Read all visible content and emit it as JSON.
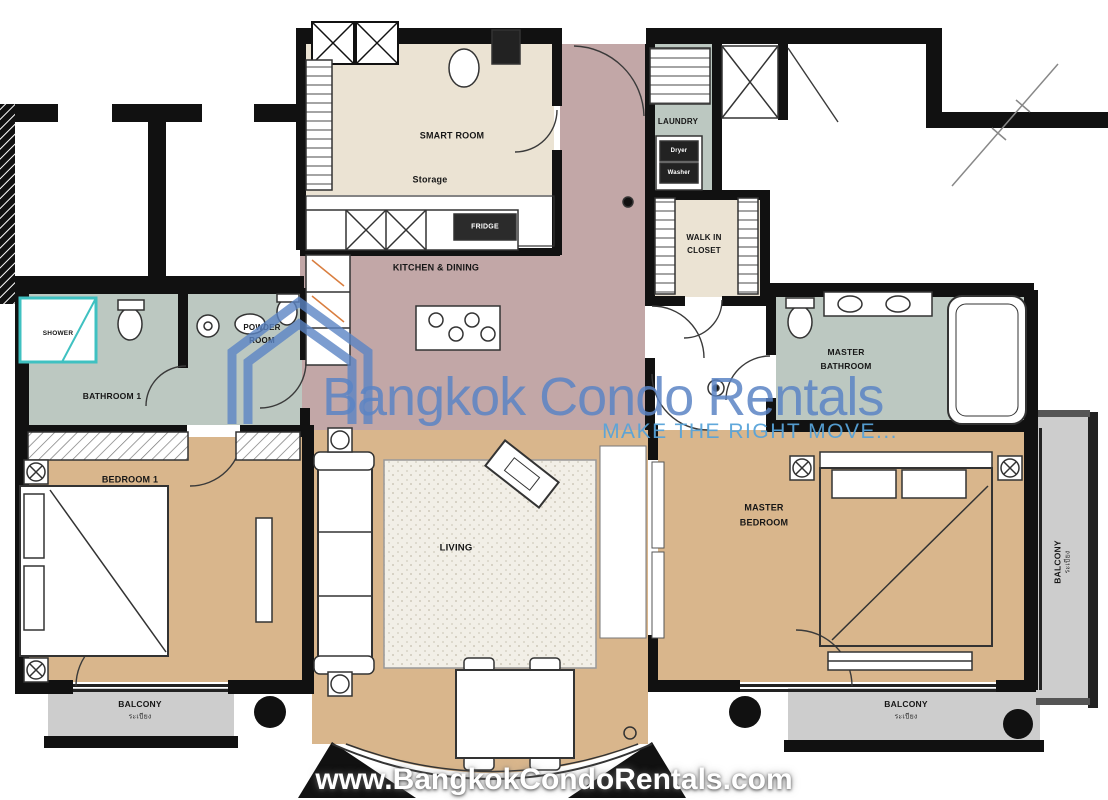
{
  "watermark": {
    "brand": "Bangkok Condo Rentals",
    "tagline": "MAKE THE RIGHT MOVE...",
    "website": "www.BangkokCondoRentals.com",
    "brand_color": "#5b84c4",
    "tagline_color": "#57a3d9"
  },
  "labels": {
    "smart_room": "SMART ROOM",
    "storage": "Storage",
    "fridge": "FRIDGE",
    "kitchen_dining": "KITCHEN & DINING",
    "laundry": "LAUNDRY",
    "dryer": "Dryer",
    "washer": "Washer",
    "walk_in_closet_1": "WALK IN",
    "walk_in_closet_2": "CLOSET",
    "powder_1": "POWDER",
    "powder_2": "ROOM",
    "bathroom1": "BATHROOM 1",
    "shower": "SHOWER",
    "bedroom1": "BEDROOM 1",
    "living": "LIVING",
    "master_bath_1": "MASTER",
    "master_bath_2": "BATHROOM",
    "master_bed_1": "MASTER",
    "master_bed_2": "BEDROOM",
    "balcony": "BALCONY",
    "balcony_sub": "ระเบียง"
  },
  "colors": {
    "floor_bedroom": "#d9b68c",
    "floor_bath": "#bcc8c1",
    "floor_kitchen": "#c2a7a7",
    "floor_utility": "#ebe3d3",
    "floor_balcony": "#cdcdcd",
    "wall": "#111111",
    "shower_accent": "#3fc1c1"
  }
}
